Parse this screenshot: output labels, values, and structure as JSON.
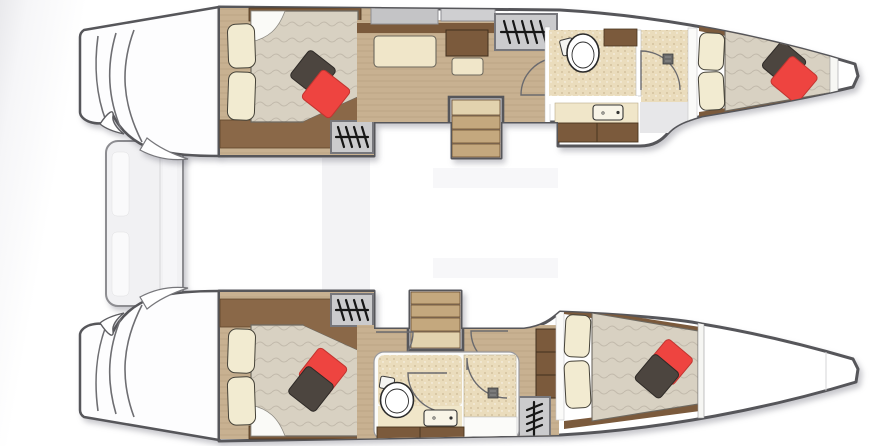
{
  "diagram": {
    "type": "floor-plan",
    "subject": "catamaran sailing yacht interior deck plan, top-down view, bow pointing right",
    "visible_text": [],
    "port_hull_top": {
      "rooms": [
        {
          "name": "aft-cabin",
          "items": [
            "double berth",
            "two cream pillows",
            "dark-grey throw pillow",
            "red throw pillow",
            "hatch companionway steps"
          ]
        },
        {
          "name": "passageway",
          "items": [
            "sofa seat",
            "desk",
            "stool",
            "grey wardrobe lockers",
            "companionway stairs",
            "hatch companionway steps"
          ]
        },
        {
          "name": "head-forward",
          "items": [
            "toilet",
            "vanity shelf",
            "washbasin counter",
            "storage cabinets",
            "shower stall with door",
            "floor drain"
          ]
        },
        {
          "name": "forward-cabin",
          "items": [
            "tapered double berth",
            "two cream pillows",
            "dark-grey throw pillow",
            "red throw pillow"
          ]
        },
        {
          "name": "forepeak",
          "items": []
        }
      ]
    },
    "starboard_hull_bottom": {
      "rooms": [
        {
          "name": "aft-cabin",
          "items": [
            "double berth",
            "two cream pillows",
            "red throw pillow",
            "dark-grey throw pillow",
            "hatch companionway steps"
          ]
        },
        {
          "name": "passageway",
          "items": [
            "companionway stairs",
            "two hinged doors",
            "wardrobe shelves",
            "vertical hatch steps"
          ]
        },
        {
          "name": "head-mid",
          "items": [
            "toilet",
            "washbasin",
            "shower stall with door",
            "floor drain",
            "storage cabinets",
            "counter"
          ]
        },
        {
          "name": "forward-cabin",
          "items": [
            "tapered double berth",
            "two cream pillows",
            "red throw pillow",
            "dark-grey throw pillow"
          ]
        },
        {
          "name": "forepeak",
          "items": []
        }
      ]
    },
    "stern": {
      "items": [
        "port transom boarding steps",
        "starboard transom boarding steps",
        "transom platform between hulls"
      ]
    }
  },
  "colors": {
    "hull_fill": "#ffffff",
    "wood_floor": "#c8b191",
    "wood_dark": "#7b5a3c",
    "wood_bench": "#8a6848",
    "bed_duvet": "#d8d1c2",
    "pillow_cream": "#f2ebd1",
    "pillow_red": "#ee4440",
    "pillow_dark": "#4c453f",
    "cabinet_gray": "#c4c4c6",
    "hatch_gray": "#cbcbcd",
    "bath_floor": "#eadcbc",
    "counter_cream": "#f0e6c9",
    "stair_light": "#e2d2ae",
    "stair_wood": "#c4a87e",
    "platform_gray": "#f1f1f3",
    "ghost_gray": "#ececef",
    "shower_gray": "#e7e7e9",
    "white_soft": "#fbfbf9",
    "scoop_fill": "#fdfdfe"
  }
}
